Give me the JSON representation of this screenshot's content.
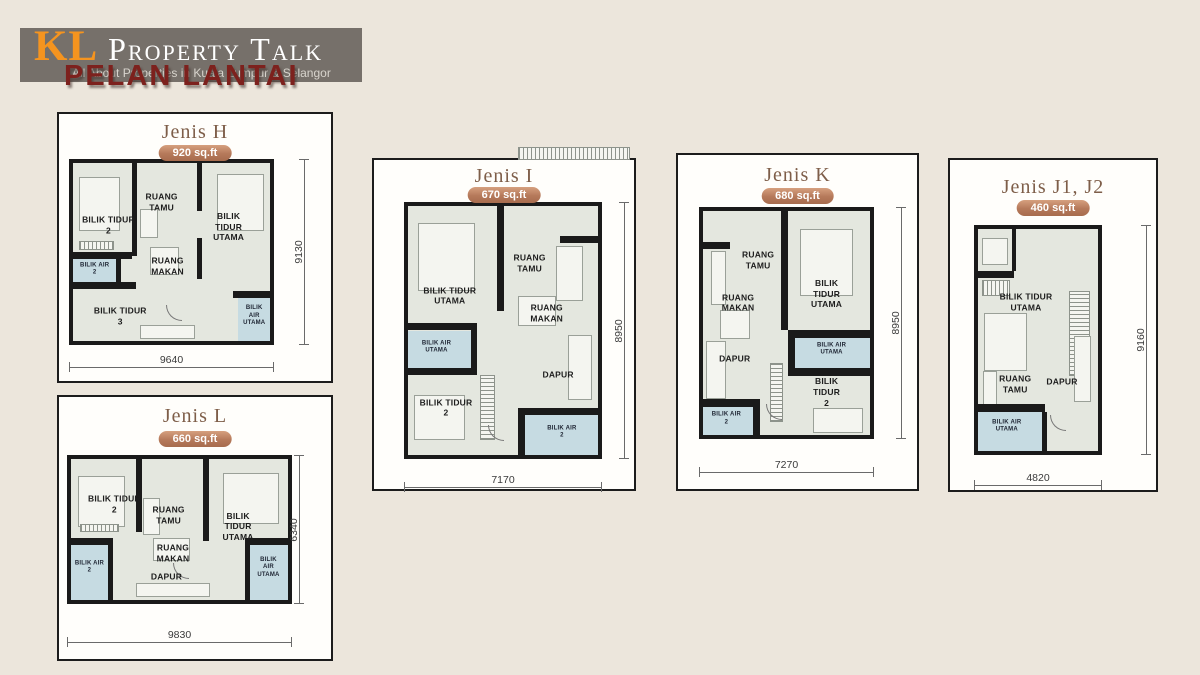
{
  "page": {
    "title": "PELAN LANTAI",
    "background": "#ece6dc"
  },
  "logo": {
    "kl": "KL",
    "name": "Property Talk",
    "tagline": "All About Properties in Kuala Lumpur & Selangor",
    "bar_color": "#76706a",
    "kl_color": "#f5941f",
    "name_color": "#ffffff",
    "page_title_color": "#7d211d"
  },
  "colors": {
    "card_background": "#fffefb",
    "card_border": "#1c1c1c",
    "floor": "#e4e7df",
    "wall": "#1a1a1a",
    "bathroom_fill": "#c6dbe2",
    "plan_title": "#7e5e49",
    "badge_top": "#d6a07f",
    "badge_bottom": "#a76c4e",
    "dimension_line": "#6a6a6a"
  },
  "plans": [
    {
      "name": "Jenis H",
      "area": "920 sq.ft",
      "width_dim": "9640",
      "height_dim": "9130",
      "rooms": [
        {
          "label": "BILIK TIDUR\n2"
        },
        {
          "label": "RUANG\nTAMU"
        },
        {
          "label": "BILIK TIDUR\nUTAMA"
        },
        {
          "label": "RUANG\nMAKAN"
        },
        {
          "label": "BILIK TIDUR\n3"
        }
      ],
      "bathrooms": [
        {
          "label": "BILIK AIR\n2"
        },
        {
          "label": "BILIK AIR\nUTAMA"
        }
      ]
    },
    {
      "name": "Jenis L",
      "area": "660 sq.ft",
      "width_dim": "9830",
      "height_dim": "6340",
      "rooms": [
        {
          "label": "BILIK TIDUR\n2"
        },
        {
          "label": "RUANG\nTAMU"
        },
        {
          "label": "BILIK TIDUR\nUTAMA"
        },
        {
          "label": "RUANG\nMAKAN"
        },
        {
          "label": "DAPUR"
        }
      ],
      "bathrooms": [
        {
          "label": "BILIK AIR\n2"
        },
        {
          "label": "BILIK AIR\nUTAMA"
        }
      ]
    },
    {
      "name": "Jenis I",
      "area": "670 sq.ft",
      "width_dim": "7170",
      "height_dim": "8950",
      "rooms": [
        {
          "label": "BILIK TIDUR\nUTAMA"
        },
        {
          "label": "RUANG\nTAMU"
        },
        {
          "label": "RUANG\nMAKAN"
        },
        {
          "label": "BILIK TIDUR\n2"
        },
        {
          "label": "DAPUR"
        }
      ],
      "bathrooms": [
        {
          "label": "BILIK AIR\nUTAMA"
        },
        {
          "label": "BILIK AIR\n2"
        }
      ]
    },
    {
      "name": "Jenis K",
      "area": "680 sq.ft",
      "width_dim": "7270",
      "height_dim": "8950",
      "rooms": [
        {
          "label": "RUANG\nTAMU"
        },
        {
          "label": "RUANG\nMAKAN"
        },
        {
          "label": "BILIK TIDUR\nUTAMA"
        },
        {
          "label": "DAPUR"
        },
        {
          "label": "BILIK TIDUR\n2"
        }
      ],
      "bathrooms": [
        {
          "label": "BILIK AIR\nUTAMA"
        },
        {
          "label": "BILIK AIR\n2"
        }
      ]
    },
    {
      "name": "Jenis J1, J2",
      "area": "460 sq.ft",
      "width_dim": "4820",
      "height_dim": "9160",
      "rooms": [
        {
          "label": "BILIK TIDUR\nUTAMA"
        },
        {
          "label": "RUANG\nTAMU"
        },
        {
          "label": "DAPUR"
        }
      ],
      "bathrooms": [
        {
          "label": "BILIK AIR\nUTAMA"
        }
      ]
    }
  ]
}
